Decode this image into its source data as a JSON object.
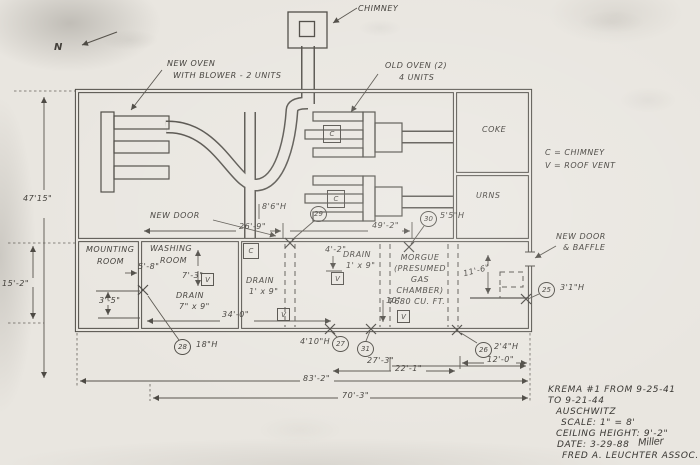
{
  "ann": {
    "chimney": "CHIMNEY",
    "north": "N",
    "new_oven_l1": "NEW OVEN",
    "new_oven_l2": "WITH BLOWER - 2 UNITS",
    "old_oven_l1": "OLD OVEN (2)",
    "old_oven_l2": "4 UNITS",
    "coke": "COKE",
    "urns": "URNS",
    "legend_c": "C = CHIMNEY",
    "legend_v": "V = ROOF VENT",
    "new_door": "NEW DOOR",
    "baffle_l1": "NEW DOOR",
    "baffle_l2": "& BAFFLE",
    "mounting_l1": "MOUNTING",
    "mounting_l2": "ROOM",
    "washing_l1": "WASHING",
    "washing_l2": "ROOM",
    "drain_wash_l1": "DRAIN",
    "drain_wash_l2": "7\" x 9\"",
    "drain_mid_l1": "DRAIN",
    "drain_mid_l2": "1' x 9\"",
    "drain_morgue_l1": "DRAIN",
    "drain_morgue_l2": "1' x 9\"",
    "morgue_l1": "MORGUE",
    "morgue_l2": "(PRESUMED",
    "morgue_l3": "GAS",
    "morgue_l4": "CHAMBER)",
    "morgue_l5": "7680 CU. FT.",
    "vent": "V",
    "chim": "C"
  },
  "dim": {
    "h47": "47'15\"",
    "h15_2": "15'-2\"",
    "w26_9": "26'-9\"",
    "w49_2": "49'-2\"",
    "h8_6": "8'6\"H",
    "h5_5": "5'5\"H",
    "w5_8": "5'-8\"",
    "h7_3": "7'-3\"",
    "h3_5": "3'-5\"",
    "w4_2": "4'-2\"",
    "w34_0": "34'-0\"",
    "h11_6": "11'-6\"",
    "d10": "10\"",
    "h3_1": "3'1\"H",
    "h18": "18\"H",
    "h4_10": "4'10\"H",
    "w27_3": "27'-3\"",
    "w22_1": "22'-1\"",
    "w12_0": "12'-0\"",
    "h2_4": "2'4\"H",
    "w83_2": "83'-2\"",
    "w70_3": "70'-3\""
  },
  "samples": {
    "s25": "25",
    "s26": "26",
    "s27": "27",
    "s28": "28",
    "s29": "29",
    "s30": "30",
    "s31": "31"
  },
  "tb": {
    "l1": "KREMA #1 FROM 9-25-41",
    "l2": "TO 9-21-44",
    "l3": "AUSCHWITZ",
    "l4": "SCALE: 1\" = 8'",
    "l5": "CEILING HEIGHT: 9'-2\"",
    "l6": "DATE: 3-29-88",
    "sig": "Miller",
    "l7": "FRED A. LEUCHTER ASSOC. IN."
  }
}
